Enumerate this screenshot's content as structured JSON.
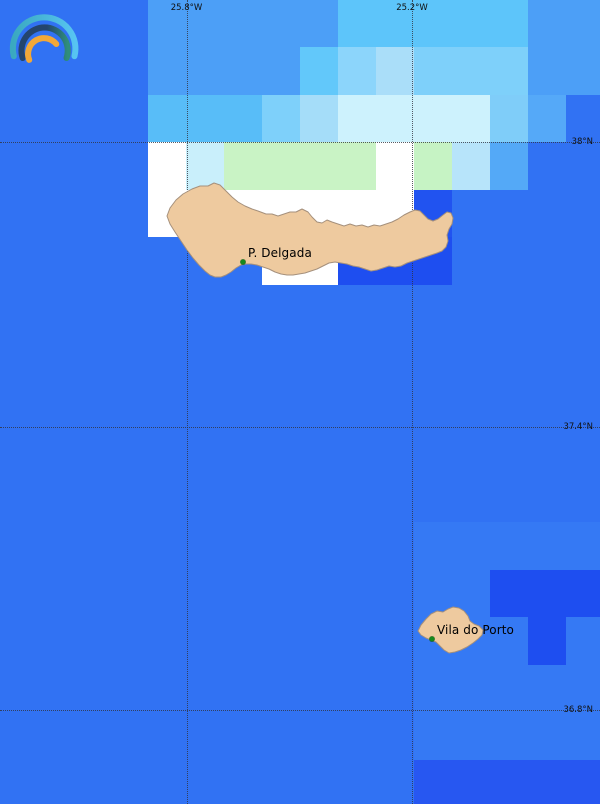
{
  "app": {
    "logo": {
      "outer_color_left": "#3aa9c0",
      "outer_color_right": "#57c4f2",
      "middle_color_left": "#24456e",
      "middle_color_right": "#2f8e7c",
      "inner_color": "#f2a838"
    }
  },
  "map": {
    "width": 600,
    "height": 804,
    "ocean_color": "#3172f3",
    "island_fill": "#eeca9f",
    "island_stroke": "#a5907c",
    "grid": {
      "origin_x": -4,
      "origin_y": -0.5,
      "cell_w": 38,
      "cell_h": 47.5,
      "cells": [
        {
          "c": 11,
          "r": 11,
          "s": 5,
          "rs": 5,
          "color": "#3579f4"
        },
        {
          "c": 4,
          "r": 0,
          "s": 5,
          "color": "#4c9ff7"
        },
        {
          "c": 9,
          "r": 0,
          "s": 5,
          "color": "#5dc5fa"
        },
        {
          "c": 14,
          "r": 0,
          "s": 2,
          "color": "#4c9ff7"
        },
        {
          "c": 4,
          "r": 1,
          "s": 4,
          "color": "#4c9ff7"
        },
        {
          "c": 8,
          "r": 1,
          "color": "#62c8fa"
        },
        {
          "c": 9,
          "r": 1,
          "color": "#8cd5fb"
        },
        {
          "c": 10,
          "r": 1,
          "color": "#aadef9"
        },
        {
          "c": 11,
          "r": 1,
          "s": 3,
          "color": "#7ed0fa"
        },
        {
          "c": 14,
          "r": 1,
          "s": 2,
          "color": "#4c9ff7"
        },
        {
          "c": 4,
          "r": 2,
          "s": 3,
          "color": "#58bdf8"
        },
        {
          "c": 7,
          "r": 2,
          "color": "#7ed0fa"
        },
        {
          "c": 8,
          "r": 2,
          "color": "#a5ddf9"
        },
        {
          "c": 9,
          "r": 2,
          "s": 4,
          "color": "#cdf2fd"
        },
        {
          "c": 13,
          "r": 2,
          "color": "#7fcdf9"
        },
        {
          "c": 14,
          "r": 2,
          "color": "#55a9f8"
        },
        {
          "c": 4,
          "r": 3,
          "color": "#ffffff"
        },
        {
          "c": 5,
          "r": 3,
          "color": "#c9effb"
        },
        {
          "c": 6,
          "r": 3,
          "s": 4,
          "color": "#c9f3c5"
        },
        {
          "c": 10,
          "r": 3,
          "color": "#ffffff"
        },
        {
          "c": 11,
          "r": 3,
          "color": "#c6f3c4"
        },
        {
          "c": 12,
          "r": 3,
          "color": "#b7e4fa"
        },
        {
          "c": 13,
          "r": 3,
          "color": "#54a9f7"
        },
        {
          "c": 4,
          "r": 4,
          "s": 7,
          "color": "#ffffff"
        },
        {
          "c": 11,
          "r": 4,
          "color": "#2153f0"
        },
        {
          "c": 7,
          "r": 5,
          "s": 2,
          "color": "#ffffff"
        },
        {
          "c": 9,
          "r": 5,
          "s": 3,
          "color": "#1e4ef0"
        },
        {
          "c": 13,
          "r": 12,
          "s": 3,
          "color": "#1e4ef0"
        },
        {
          "c": 14,
          "r": 13,
          "color": "#1e4ef0"
        },
        {
          "c": 11,
          "r": 16,
          "s": 5,
          "color": "#2757f1"
        }
      ]
    },
    "gridlines": {
      "label_color": "#101010",
      "meridians": [
        {
          "label": "25.8°W",
          "x": 186.5
        },
        {
          "label": "25.2°W",
          "x": 412
        }
      ],
      "parallels": [
        {
          "label": "38°N",
          "y": 142
        },
        {
          "label": "37.4°N",
          "y": 427
        },
        {
          "label": "36.8°N",
          "y": 710
        }
      ]
    },
    "islands": [
      {
        "name": "Sao Miguel",
        "points": [
          [
            167,
            216
          ],
          [
            170,
            208
          ],
          [
            176,
            200
          ],
          [
            183,
            194
          ],
          [
            192,
            189
          ],
          [
            200,
            186
          ],
          [
            208,
            186
          ],
          [
            214,
            183
          ],
          [
            220,
            185
          ],
          [
            226,
            191
          ],
          [
            232,
            197
          ],
          [
            238,
            202
          ],
          [
            245,
            206
          ],
          [
            252,
            209
          ],
          [
            258,
            211
          ],
          [
            266,
            214
          ],
          [
            272,
            214
          ],
          [
            278,
            216
          ],
          [
            284,
            214
          ],
          [
            290,
            212
          ],
          [
            296,
            212
          ],
          [
            302,
            209
          ],
          [
            308,
            212
          ],
          [
            312,
            217
          ],
          [
            317,
            222
          ],
          [
            322,
            223
          ],
          [
            327,
            220
          ],
          [
            332,
            222
          ],
          [
            338,
            224
          ],
          [
            344,
            226
          ],
          [
            350,
            224
          ],
          [
            356,
            226
          ],
          [
            362,
            225
          ],
          [
            368,
            227
          ],
          [
            374,
            225
          ],
          [
            380,
            226
          ],
          [
            386,
            224
          ],
          [
            392,
            222
          ],
          [
            398,
            219
          ],
          [
            404,
            215
          ],
          [
            410,
            212
          ],
          [
            415,
            210
          ],
          [
            420,
            211
          ],
          [
            424,
            215
          ],
          [
            428,
            219
          ],
          [
            433,
            221
          ],
          [
            438,
            219
          ],
          [
            443,
            215
          ],
          [
            447,
            212
          ],
          [
            451,
            213
          ],
          [
            453,
            218
          ],
          [
            452,
            224
          ],
          [
            449,
            229
          ],
          [
            447,
            235
          ],
          [
            448,
            241
          ],
          [
            446,
            247
          ],
          [
            442,
            251
          ],
          [
            437,
            253
          ],
          [
            431,
            255
          ],
          [
            425,
            257
          ],
          [
            419,
            259
          ],
          [
            413,
            261
          ],
          [
            407,
            263
          ],
          [
            401,
            266
          ],
          [
            395,
            267
          ],
          [
            389,
            266
          ],
          [
            383,
            268
          ],
          [
            377,
            270
          ],
          [
            371,
            271
          ],
          [
            365,
            269
          ],
          [
            359,
            267
          ],
          [
            353,
            266
          ],
          [
            347,
            264
          ],
          [
            341,
            263
          ],
          [
            335,
            262
          ],
          [
            329,
            263
          ],
          [
            323,
            266
          ],
          [
            317,
            269
          ],
          [
            311,
            271
          ],
          [
            305,
            273
          ],
          [
            299,
            274
          ],
          [
            293,
            275
          ],
          [
            287,
            275
          ],
          [
            281,
            274
          ],
          [
            275,
            272
          ],
          [
            269,
            269
          ],
          [
            263,
            267
          ],
          [
            257,
            265
          ],
          [
            251,
            264
          ],
          [
            246,
            264
          ],
          [
            241,
            265
          ],
          [
            236,
            268
          ],
          [
            231,
            272
          ],
          [
            226,
            275
          ],
          [
            221,
            277
          ],
          [
            215,
            277
          ],
          [
            210,
            275
          ],
          [
            205,
            271
          ],
          [
            199,
            265
          ],
          [
            193,
            258
          ],
          [
            187,
            250
          ],
          [
            181,
            241
          ],
          [
            175,
            232
          ],
          [
            170,
            224
          ]
        ]
      },
      {
        "name": "Santa Maria",
        "points": [
          [
            418,
            631
          ],
          [
            421,
            625
          ],
          [
            426,
            619
          ],
          [
            431,
            614
          ],
          [
            437,
            611
          ],
          [
            443,
            612
          ],
          [
            448,
            609
          ],
          [
            453,
            607
          ],
          [
            459,
            608
          ],
          [
            464,
            611
          ],
          [
            468,
            616
          ],
          [
            470,
            621
          ],
          [
            474,
            624
          ],
          [
            479,
            626
          ],
          [
            483,
            630
          ],
          [
            482,
            635
          ],
          [
            478,
            639
          ],
          [
            473,
            643
          ],
          [
            467,
            647
          ],
          [
            461,
            650
          ],
          [
            455,
            652
          ],
          [
            449,
            653
          ],
          [
            444,
            650
          ],
          [
            440,
            646
          ],
          [
            436,
            642
          ],
          [
            431,
            640
          ],
          [
            426,
            638
          ],
          [
            421,
            635
          ]
        ]
      }
    ],
    "cities": [
      {
        "name": "P. Delgada",
        "label_x": 248,
        "label_y": 246,
        "dot_x": 243,
        "dot_y": 262,
        "dot_color": "#15891c"
      },
      {
        "name": "Vila do Porto",
        "label_x": 437,
        "label_y": 623,
        "dot_x": 432,
        "dot_y": 639,
        "dot_color": "#15891c"
      }
    ]
  }
}
